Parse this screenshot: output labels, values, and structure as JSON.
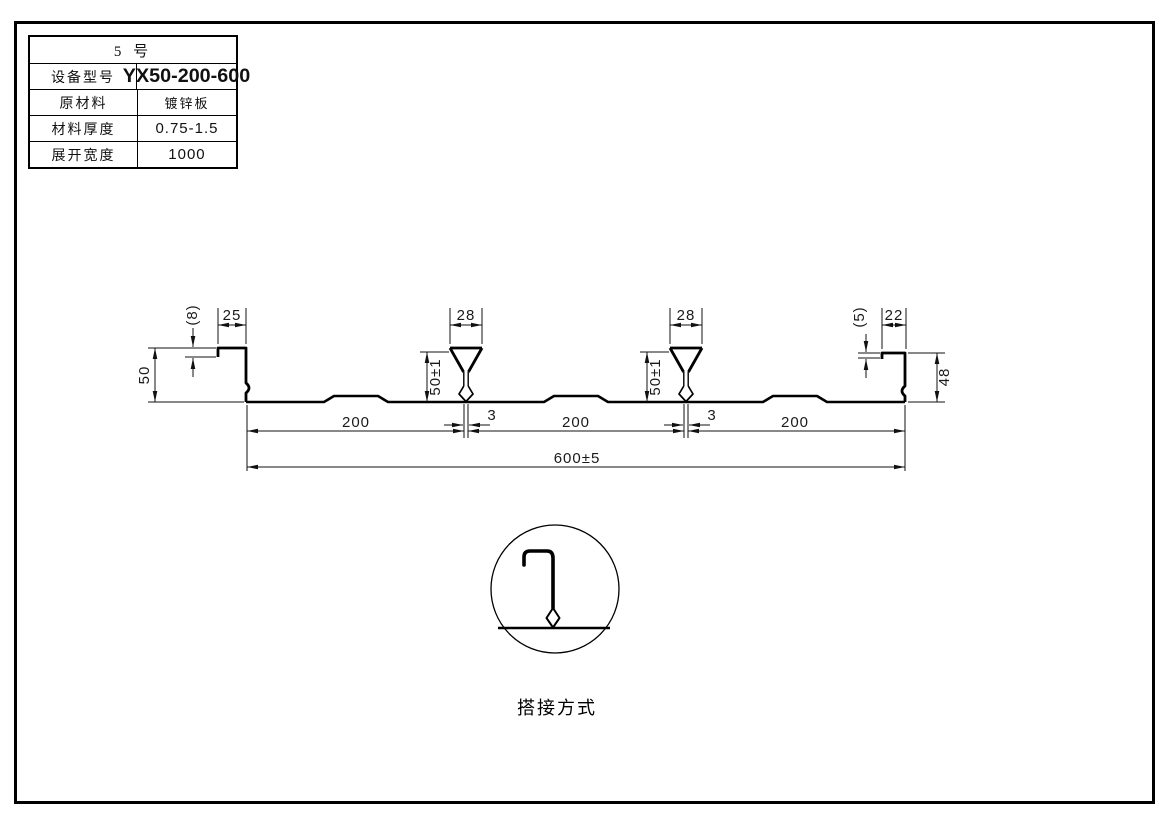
{
  "colors": {
    "line": "#1a1a1a",
    "background": "#ffffff"
  },
  "spec_table": {
    "title": "5  号",
    "rows": [
      {
        "label": "设备型号",
        "value": "YX50-200-600"
      },
      {
        "label": "原材料",
        "value": "镀锌板"
      },
      {
        "label": "材料厚度",
        "value": "0.75-1.5"
      },
      {
        "label": "展开宽度",
        "value": "1000"
      }
    ]
  },
  "drawing": {
    "dims": {
      "left": {
        "lip": "(8)",
        "top": "25",
        "height": "50"
      },
      "rib1": {
        "top": "28",
        "height": "50±1",
        "slot": "3"
      },
      "rib2": {
        "top": "28",
        "height": "50±1",
        "slot": "3"
      },
      "right": {
        "lip": "(5)",
        "top": "22",
        "height": "48"
      },
      "bottom": {
        "span1": "200",
        "span2": "200",
        "span3": "200",
        "overall": "600±5"
      }
    },
    "detail_caption": "搭接方式"
  }
}
